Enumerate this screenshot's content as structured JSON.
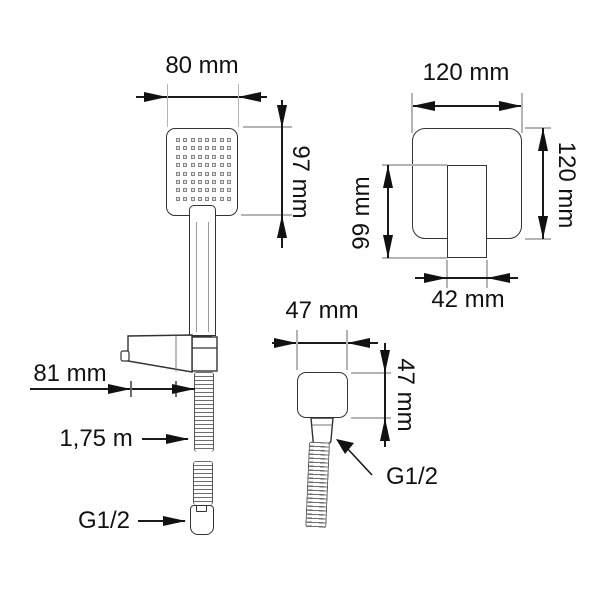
{
  "drawing_title": "Shower set technical drawing",
  "colors": {
    "background": "#ffffff",
    "outline": "#333333",
    "dimension_line": "#111111",
    "extension_line": "#b4b4b4",
    "hose_stripe": "#6e6e6e",
    "text": "#111111"
  },
  "hand_shower": {
    "head_width_label": "80 mm",
    "head_height_label": "97 mm",
    "bracket_depth_label": "81 mm",
    "hose_length_label": "1,75 m",
    "hose_thread_label": "G1/2"
  },
  "mixer_plate": {
    "width_label": "120 mm",
    "height_label": "120 mm",
    "handle_length_label": "99 mm",
    "handle_width_label": "42 mm"
  },
  "wall_outlet": {
    "width_label": "47 mm",
    "height_label": "47 mm",
    "thread_label": "G1/2"
  },
  "nozzle_grid": {
    "rows": 8,
    "cols": 8
  }
}
